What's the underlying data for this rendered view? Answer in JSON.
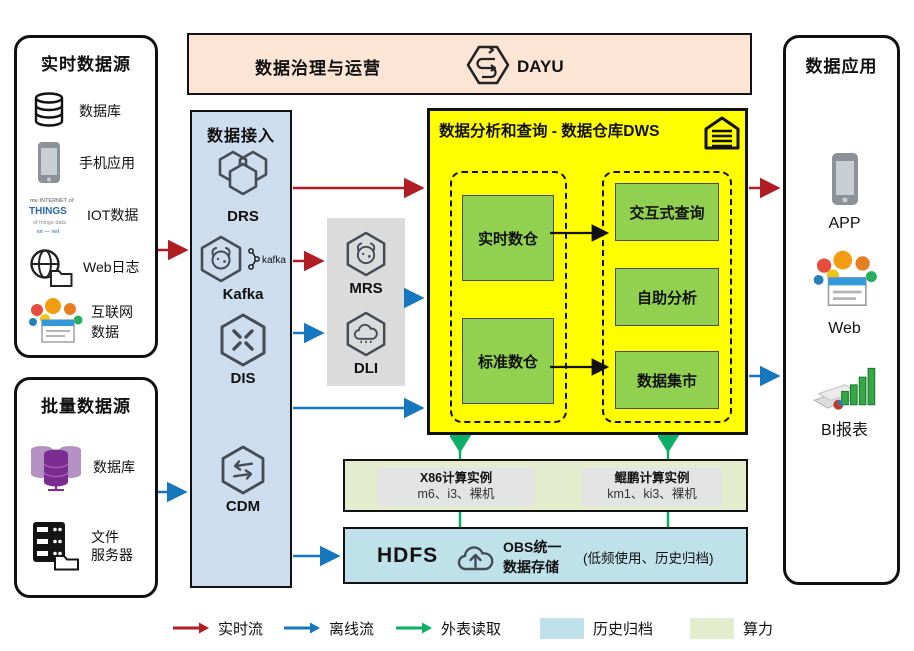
{
  "banner": {
    "title": "数据治理与运营",
    "product": "DAYU"
  },
  "realtime_sources": {
    "title": "实时数据源",
    "items": [
      {
        "icon": "database-icon",
        "label": "数据库"
      },
      {
        "icon": "mobile-icon",
        "label": "手机应用"
      },
      {
        "icon": "iot-icon",
        "label": "IOT数据"
      },
      {
        "icon": "weblog-icon",
        "label": "Web日志"
      },
      {
        "icon": "internet-icon",
        "label": "互联网\n数据"
      }
    ]
  },
  "batch_sources": {
    "title": "批量数据源",
    "items": [
      {
        "icon": "database-purple-icon",
        "label": "数据库"
      },
      {
        "icon": "file-server-icon",
        "label": "文件\n服务器"
      }
    ]
  },
  "ingestion": {
    "title": "数据接入",
    "items": [
      {
        "label": "DRS"
      },
      {
        "label": "Kafka",
        "badge": "kafka"
      },
      {
        "label": "DIS"
      },
      {
        "label": "CDM"
      }
    ]
  },
  "processing": {
    "items": [
      {
        "label": "MRS"
      },
      {
        "label": "DLI"
      }
    ]
  },
  "dws": {
    "title": "数据分析和查询 - 数据仓库DWS",
    "warehouses": [
      {
        "label": "实时数仓"
      },
      {
        "label": "标准数仓"
      }
    ],
    "services": [
      {
        "label": "交互式查询"
      },
      {
        "label": "自助分析"
      },
      {
        "label": "数据集市"
      }
    ]
  },
  "compute": {
    "instances": [
      {
        "name": "X86计算实例",
        "spec": "m6、i3、裸机"
      },
      {
        "name": "鲲鹏计算实例",
        "spec": "km1、ki3、裸机"
      }
    ]
  },
  "storage": {
    "hdfs": "HDFS",
    "obs": "OBS统一\n数据存储",
    "note": "(低频使用、历史归档)"
  },
  "applications": {
    "title": "数据应用",
    "items": [
      {
        "label": "APP"
      },
      {
        "label": "Web"
      },
      {
        "label": "BI报表"
      }
    ]
  },
  "legend": {
    "items": [
      {
        "label": "实时流",
        "type": "arrow",
        "color": "#b01e23"
      },
      {
        "label": "离线流",
        "type": "arrow",
        "color": "#1777be"
      },
      {
        "label": "外表读取",
        "type": "arrow",
        "color": "#0fae67"
      },
      {
        "label": "历史归档",
        "type": "swatch",
        "color": "#bfe1ea"
      },
      {
        "label": "算力",
        "type": "swatch",
        "color": "#e3eccd"
      }
    ]
  },
  "colors": {
    "realtime_flow": "#b01e23",
    "offline_flow": "#1777be",
    "external_read": "#0fae67",
    "dws_bg": "#ffff00",
    "warehouse_green": "#92d050",
    "banner_bg": "#fce5d5",
    "ingestion_bg": "#cdddee",
    "archive_bg": "#bfe1ea",
    "compute_bg": "#e3eccd"
  }
}
